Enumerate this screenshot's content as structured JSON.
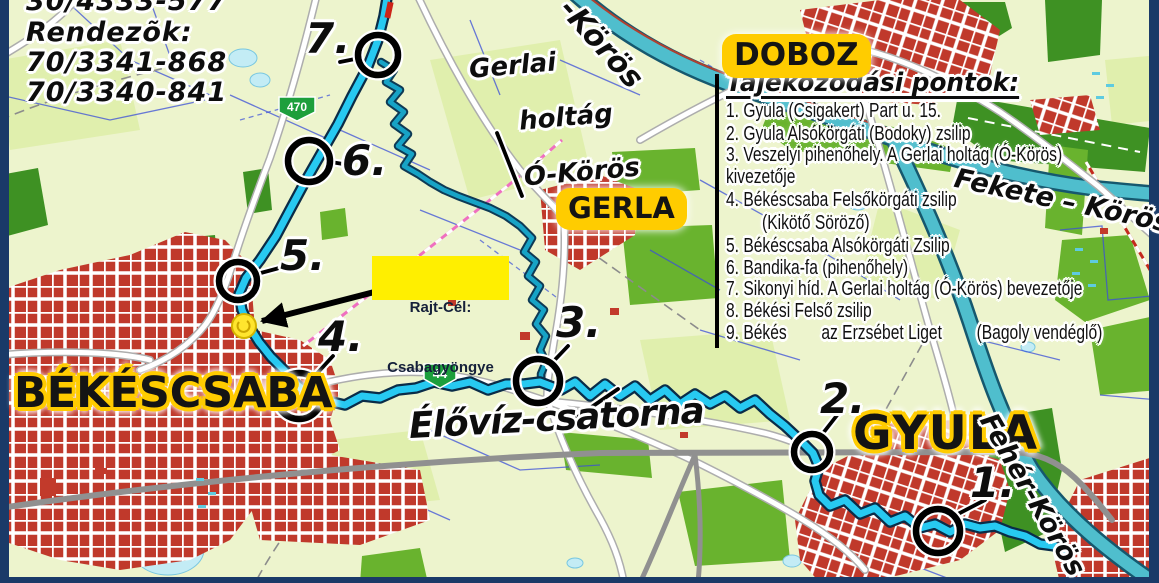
{
  "contact": {
    "line1": "30/4333-577",
    "line2": "Rendezõk:",
    "line3": "70/3341-868",
    "line4": "70/3340-841"
  },
  "legend": {
    "title": "Tájékozódási pontok:",
    "lines": [
      "1. Gyula (Csigakert) Part u. 15.",
      "2. Gyula Alsókörgáti (Bodoky) zsilip",
      "3. Veszelyi pihenőhely. A Gerlai holtág (Ó-Körös)",
      "kivezetője",
      "4. Békéscsaba Felsőkörgáti zsilip",
      "(Kikötő Söröző)",
      "5. Békéscsaba Alsókörgáti Zsilip",
      "6. Bandika-fa (pihenőhely)",
      "7. Sikonyi híd. A Gerlai holtág (Ó-Körös) bevezetője",
      "8. Békési Felső zsilip",
      "9. Békés        az Erzsébet Liget        (Bagoly vendéglő)"
    ]
  },
  "towns": {
    "bekescsaba": "BÉKÉSCSABA",
    "gyula": "GYULA",
    "gerla": "GERLA",
    "doboz": "DOBOZ"
  },
  "waters": {
    "elovize": "Élővíz-csatorna",
    "gerlai": [
      "Gerlai",
      "holtág",
      "Ó-Körös"
    ],
    "fekete": "Fekete – Körös",
    "feher": "Fehér-Körös",
    "kettos": "-Körös"
  },
  "shields": {
    "r470": "470",
    "r44": "44"
  },
  "start": {
    "line1": "Rajt-Cél:",
    "line2": "Csabagyöngye"
  },
  "points": {
    "p1": "1.",
    "p2": "2.",
    "p3": "3.",
    "p4": "4.",
    "p5": "5.",
    "p6": "6.",
    "p7": "7."
  },
  "colors": {
    "route_cyan": "#27c9f1",
    "route_casing": "#0a2c48",
    "oxbow_teal": "#17a3c6",
    "river_teal": "#4fbecd",
    "town_red": "#c0392b",
    "label_halo_yellow": "#ffcc00",
    "start_box_yellow": "#ffef00",
    "frame_navy": "#1a3a68",
    "land": "#edf4cd",
    "forest": "#69b32e",
    "forest_dark": "#3e9123",
    "shield_green": "#1d9f3c"
  }
}
